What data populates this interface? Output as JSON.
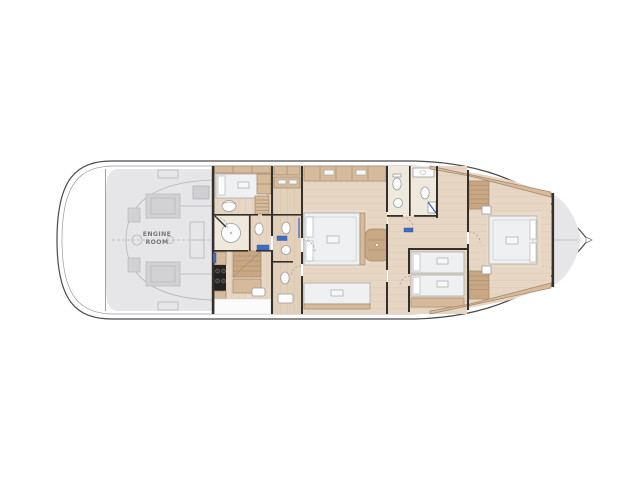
{
  "window": {
    "background": "#ffffff"
  },
  "floor_plan": {
    "kind": "yacht-lower-deck-floor-plan",
    "engine_room": {
      "label_line1": "ENGINE",
      "label_line2": "ROOM"
    }
  },
  "colors": {
    "bg": "#ffffff",
    "hull-stroke": "#4a4a4a",
    "inner-hull-stroke": "#9a9a9a",
    "wall": "#33302c",
    "wood-floor": "#e6d6c3",
    "wood-floor-2": "#e2d0ba",
    "wood-mid": "#d5ba9b",
    "wood-dark": "#c8a883",
    "wood-stroke": "#a5866a",
    "bed-platform": "#e9dbc9",
    "gray-room": "#e6e6e8",
    "gray-line": "#b7b7ba",
    "gray-box": "#d2d2d5",
    "engine-text": "#77777b",
    "fixture-fill": "#fdfdfd",
    "fixture-stroke": "#9c9c9c",
    "bed-fill": "#eef0f1",
    "bed-stroke": "#aaaaaa",
    "accent-blue": "#3f6dc0",
    "cooktop": "#242220",
    "arc": "#999999"
  }
}
